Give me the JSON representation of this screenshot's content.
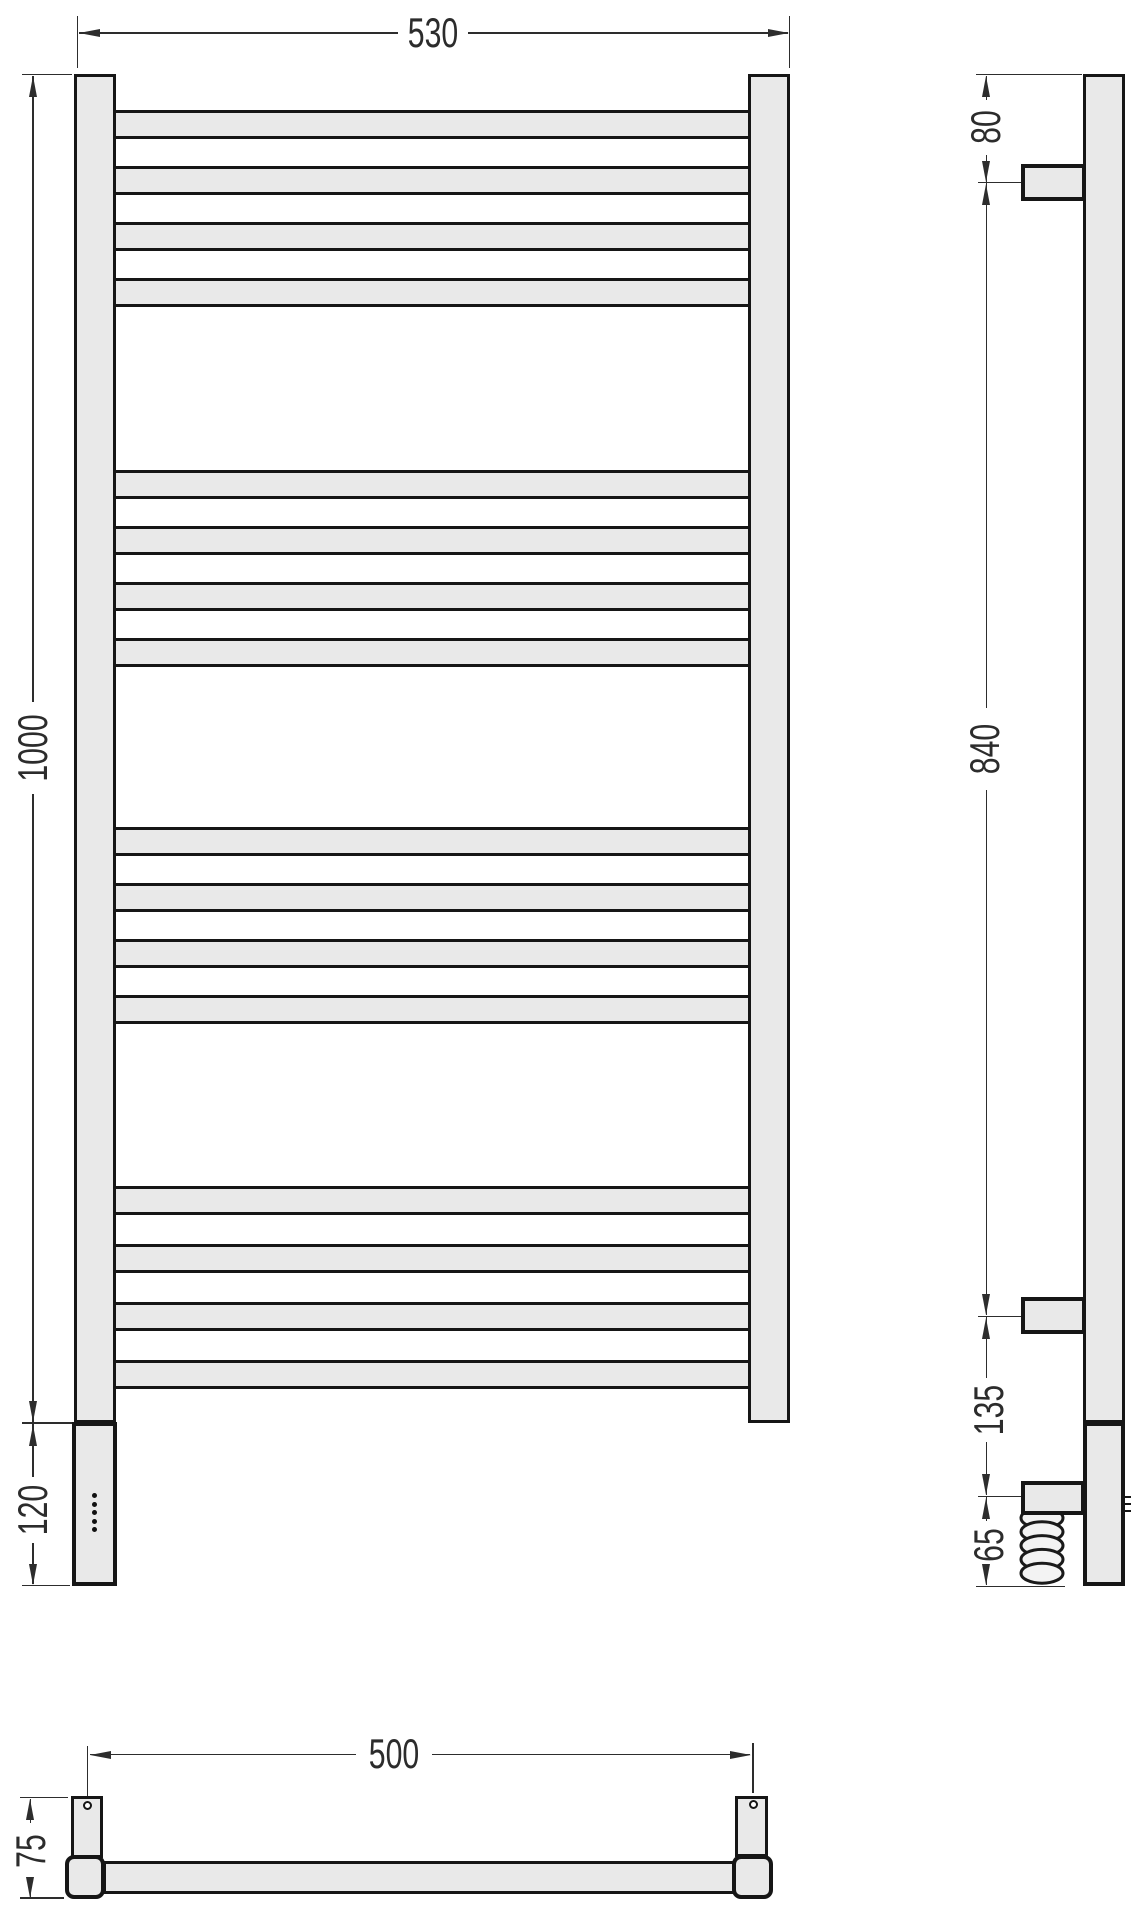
{
  "drawing": {
    "kind": "towel-radiator dimensional drawing",
    "views": [
      "front",
      "side",
      "bottom"
    ]
  },
  "colors": {
    "fill": "#e9e9e9",
    "outline": "#161616",
    "dimension": "#2d2d2d",
    "background": "#ffffff"
  },
  "dimensions": {
    "front_width": "530",
    "front_height": "1000",
    "front_bottom_section": "120",
    "side_top_to_bracket": "80",
    "side_bracket_span": "840",
    "side_bracket_to_element": "135",
    "side_element_to_bottom": "65",
    "bottom_mount_span": "500",
    "bottom_depth": "75"
  },
  "front_view": {
    "rung_groups": [
      {
        "start_y": 110,
        "count": 4,
        "pitch": 56
      },
      {
        "start_y": 470,
        "count": 4,
        "pitch": 56
      },
      {
        "start_y": 827,
        "count": 4,
        "pitch": 56
      },
      {
        "start_y": 1186,
        "count": 4,
        "pitch": 58
      }
    ],
    "rung_height": 29,
    "indicator_dots": {
      "count": 5
    }
  },
  "side_view": {
    "coil_loops": 5,
    "wall_brackets": 2
  },
  "bottom_view": {
    "mount_holes": 2
  }
}
